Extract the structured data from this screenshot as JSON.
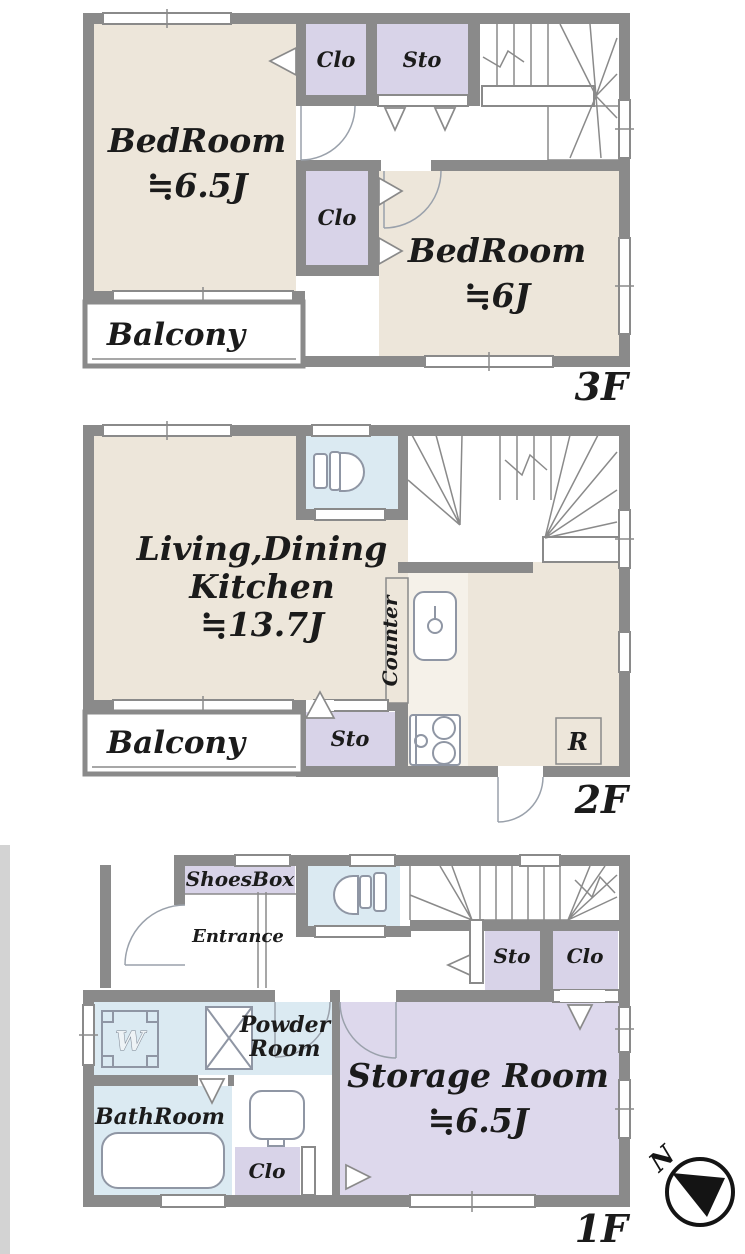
{
  "colors": {
    "wall": "#8a8a8a",
    "beige": "#ede6da",
    "lavender": "#d8d3e8",
    "wet_blue": "#dbeaf2",
    "storage_lavender": "#ddd8ec",
    "outside_strip": "#d3d3d3",
    "fixture_line": "#8f96a4",
    "text_ink": "#1b1b1b"
  },
  "floor3": {
    "floor_label": "3F",
    "bedroom1_name": "BedRoom",
    "bedroom1_size": "≒6.5J",
    "bedroom2_name": "BedRoom",
    "bedroom2_size": "≒6J",
    "closet_top": "Clo",
    "storage": "Sto",
    "closet_mid": "Clo",
    "balcony": "Balcony"
  },
  "floor2": {
    "floor_label": "2F",
    "ldk_line1": "Living,Dining",
    "ldk_line2": "Kitchen",
    "ldk_size": "≒13.7J",
    "counter": "Counter",
    "storage": "Sto",
    "refrigerator": "R",
    "balcony": "Balcony"
  },
  "floor1": {
    "floor_label": "1F",
    "shoesbox": "ShoesBox",
    "entrance": "Entrance",
    "storage_upper": "Sto",
    "closet_upper": "Clo",
    "washer": "W",
    "powder_line1": "Powder",
    "powder_line2": "Room",
    "bathroom": "BathRoom",
    "closet_lower": "Clo",
    "storage_room_name": "Storage Room",
    "storage_room_size": "≒6.5J"
  },
  "compass": {
    "north": "N"
  }
}
